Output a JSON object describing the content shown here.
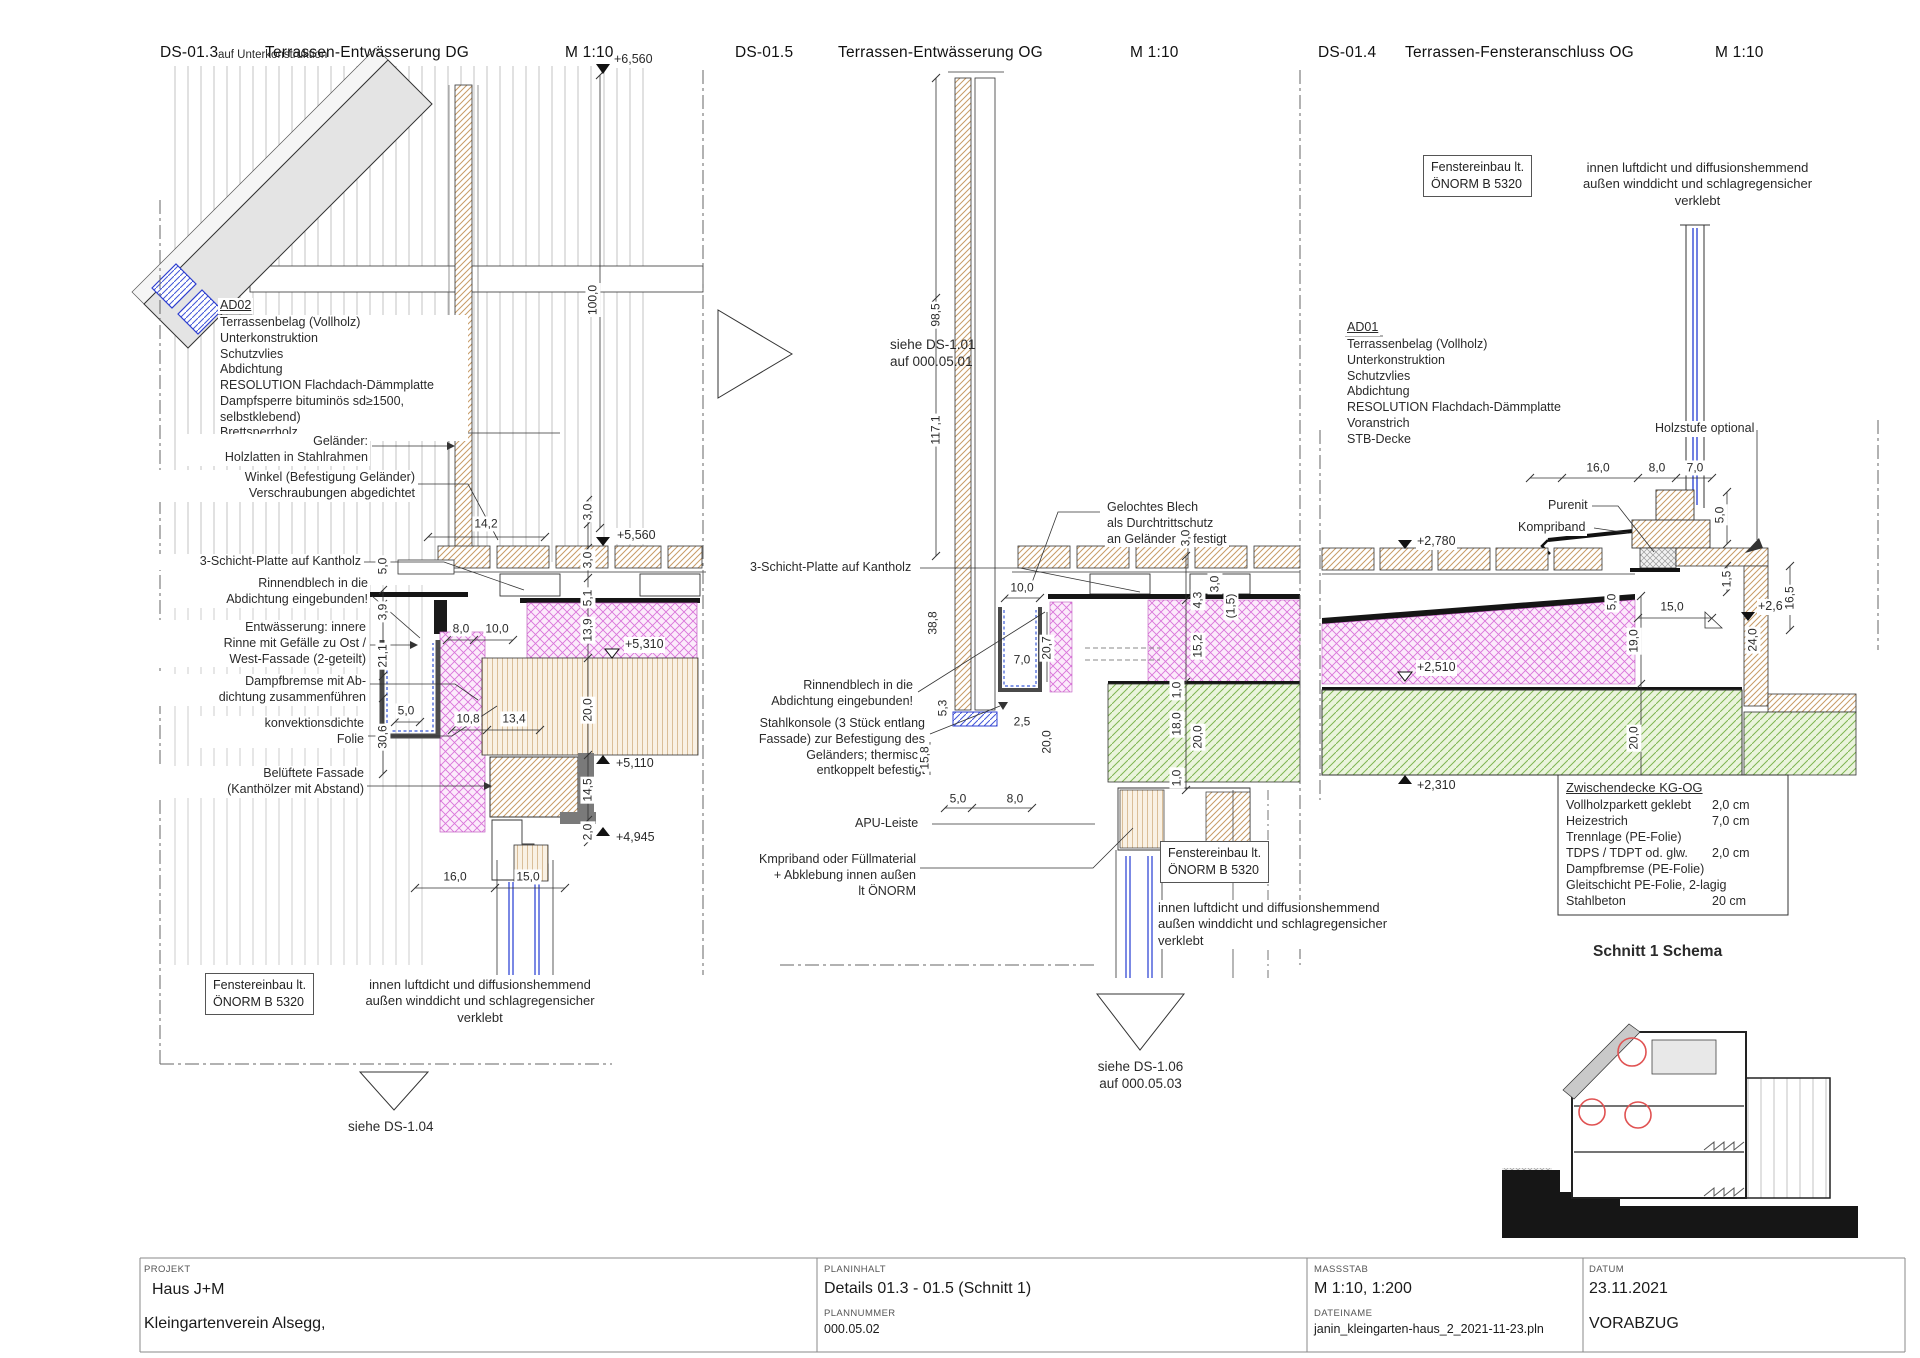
{
  "titles": [
    {
      "code": "DS-01.3",
      "name": "Terrassen-Entwässerung DG",
      "scale": "M 1:10"
    },
    {
      "code": "DS-01.5",
      "name": "Terrassen-Entwässerung OG",
      "scale": "M 1:10"
    },
    {
      "code": "DS-01.4",
      "name": "Terrassen-Fensteranschluss OG",
      "scale": "M 1:10"
    }
  ],
  "left": {
    "cut_note": "auf Unterkonstruktion",
    "ad02_title": "AD02",
    "ad02_lines": "Terrassenbelag (Vollholz)\nUnterkonstruktion\nSchutzvlies\nAbdichtung\nRESOLUTION Flachdach-Dämmplatte\nDampfsperre bituminös sd≥1500, selbstklebend)\nBrettsperrholz",
    "ann_gelaender": "Geländer:\nHolzlatten in Stahlrahmen",
    "ann_winkel": "Winkel (Befestigung Geländer)\nVerschraubungen abgedichtet",
    "ann_schicht": "3-Schicht-Platte auf Kantholz",
    "ann_rinne": "Rinnendblech in die\nAbdichtung eingebunden!",
    "ann_entw": "Entwässerung:  innere\nRinne mit Gefälle zu Ost /\nWest-Fassade (2-geteilt)",
    "ann_dampf": "Dampfbremse mit Ab-\ndichtung zusammenführen",
    "ann_folie": "konvektionsdichte\nFolie",
    "ann_fassade": "Belüftete Fassade\n(Kanthölzer mit Abstand)",
    "box_fenster": "Fenstereinbau lt.\nÖNORM B 5320",
    "note_fenster": "innen luftdicht und diffusionshemmend\naußen winddicht und schlagregensicher\nverklebt",
    "see": "siehe DS-1.04",
    "elev": {
      "e6560": "+6,560",
      "e5560": "+5,560",
      "e5310": "+5,310",
      "e5110": "+5,110",
      "e4945": "+4,945"
    },
    "dims": {
      "d14_2": "14,2",
      "d100_0": "100,0",
      "d3_0a": "3,0",
      "d3_0b": "3,0",
      "d5_1": "5,1",
      "d13_9": "13,9",
      "d20_0": "20,0",
      "d14_5": "14,5",
      "d2_0": "2,0",
      "d5_0top": "5,0",
      "d3_9": "3,9",
      "d21_1": "21,1",
      "d30_6": "30,6",
      "d5_0": "5,0",
      "d8_0": "8,0",
      "d10_0": "10,0",
      "d10_8": "10,8",
      "d13_4": "13,4",
      "d16_0": "16,0",
      "d15_0": "15,0"
    }
  },
  "middle": {
    "see_top": "siehe DS-1.01\nauf 000.05.01",
    "ann_blech": "Gelochtes Blech\nals Durchtrittschutz\nan Geländer befestigt",
    "ann_schicht": "3-Schicht-Platte auf Kantholz",
    "ann_rinne": "Rinnendblech in die\nAbdichtung eingebunden!",
    "ann_konsole": "Stahlkonsole (3 Stück entlang\nFassade) zur Befestigung des\nGeländers; thermisch\nentkoppelt befestigt",
    "ann_apu": "APU-Leiste",
    "ann_kmpriband": "Kmpriband oder Füllmaterial\n+ Abklebung innen außen\nlt ÖNORM",
    "box_fenster": "Fenstereinbau lt.\nÖNORM B 5320",
    "note_fenster": "innen luftdicht und diffusionshemmend\naußen winddicht und schlagregensicher\nverklebt",
    "see_bottom": "siehe DS-1.06\nauf 000.05.03",
    "dims": {
      "d98_5": "98,5",
      "d117_1": "117,1",
      "d38_8": "38,8",
      "d10_0": "10,0",
      "d20_7": "20,7",
      "d7_0": "7,0",
      "d5_3": "5,3",
      "d2_5": "2,5",
      "d15_8": "15,8",
      "d20_0a": "20,0",
      "d5_0": "5,0",
      "d8_0": "8,0",
      "d3_0deck": "3,0",
      "d4_3": "4,3",
      "d3_0r": "3,0",
      "d1_5": "(1,5)",
      "d15_2": "15,2",
      "d1_0a": "1,0",
      "d18_0": "18,0",
      "d20_0b": "20,0",
      "d1_0b": "1,0"
    }
  },
  "right": {
    "box_fenster": "Fenstereinbau lt.\nÖNORM B 5320",
    "note_fenster": "innen luftdicht und diffusionshemmend\naußen winddicht und schlagregensicher\nverklebt",
    "ad01_title": "AD01",
    "ad01_lines": "Terrassenbelag (Vollholz)\nUnterkonstruktion\nSchutzvlies\nAbdichtung\nRESOLUTION Flachdach-Dämmplatte\nVoranstrich\nSTB-Decke",
    "ann_holzstufe": "Holzstufe optional",
    "ann_purenit": "Purenit",
    "ann_kompriband": "Kompriband",
    "elev": {
      "e2780": "+2,780",
      "e2620": "+2,620",
      "e2510": "+2,510",
      "e2310": "+2,310"
    },
    "dims": {
      "d16_0": "16,0",
      "d8_0": "8,0",
      "d7_0": "7,0",
      "d5_0step": "5,0",
      "d1_5": "1,5",
      "d16_5": "16,5",
      "d24_0": "24,0",
      "d15_0": "15,0",
      "d5_0": "5,0",
      "d19_0": "19,0",
      "d20_0": "20,0"
    },
    "table": {
      "title": "Zwischendecke KG-OG",
      "rows": [
        {
          "name": "Vollholzparkett geklebt",
          "val": "2,0 cm"
        },
        {
          "name": "Heizestrich",
          "val": "7,0 cm"
        },
        {
          "name": "Trennlage (PE-Folie)",
          "val": ""
        },
        {
          "name": "TDPS / TDPT od. glw.",
          "val": "2,0 cm"
        },
        {
          "name": "Dampfbremse (PE-Folie)",
          "val": ""
        },
        {
          "name": "Gleitschicht PE-Folie, 2-lagig",
          "val": ""
        },
        {
          "name": "Stahlbeton",
          "val": "20 cm"
        }
      ]
    },
    "schema_title": "Schnitt 1 Schema"
  },
  "titleblock": {
    "project_label": "PROJEKT",
    "project_line1": "Haus J+M",
    "project_line2": "Kleingartenverein Alsegg,",
    "content_label": "PLANINHALT",
    "content": "Details 01.3 - 01.5 (Schnitt 1)",
    "number_label": "PLANNUMMER",
    "number": "000.05.02",
    "scale_label": "MASSSTAB",
    "scale": "M 1:10, 1:200",
    "file_label": "DATEINAME",
    "file": "janin_kleingarten-haus_2_2021-11-23.pln",
    "date_label": "DATUM",
    "date": "23.11.2021",
    "status": "VORABZUG"
  },
  "colors": {
    "insulation_pink": "#da74da",
    "wood_hatch": "#c79b66",
    "concrete_green": "#7fb552",
    "glazing_blue": "#4256d8",
    "marker_red": "#e05252"
  }
}
